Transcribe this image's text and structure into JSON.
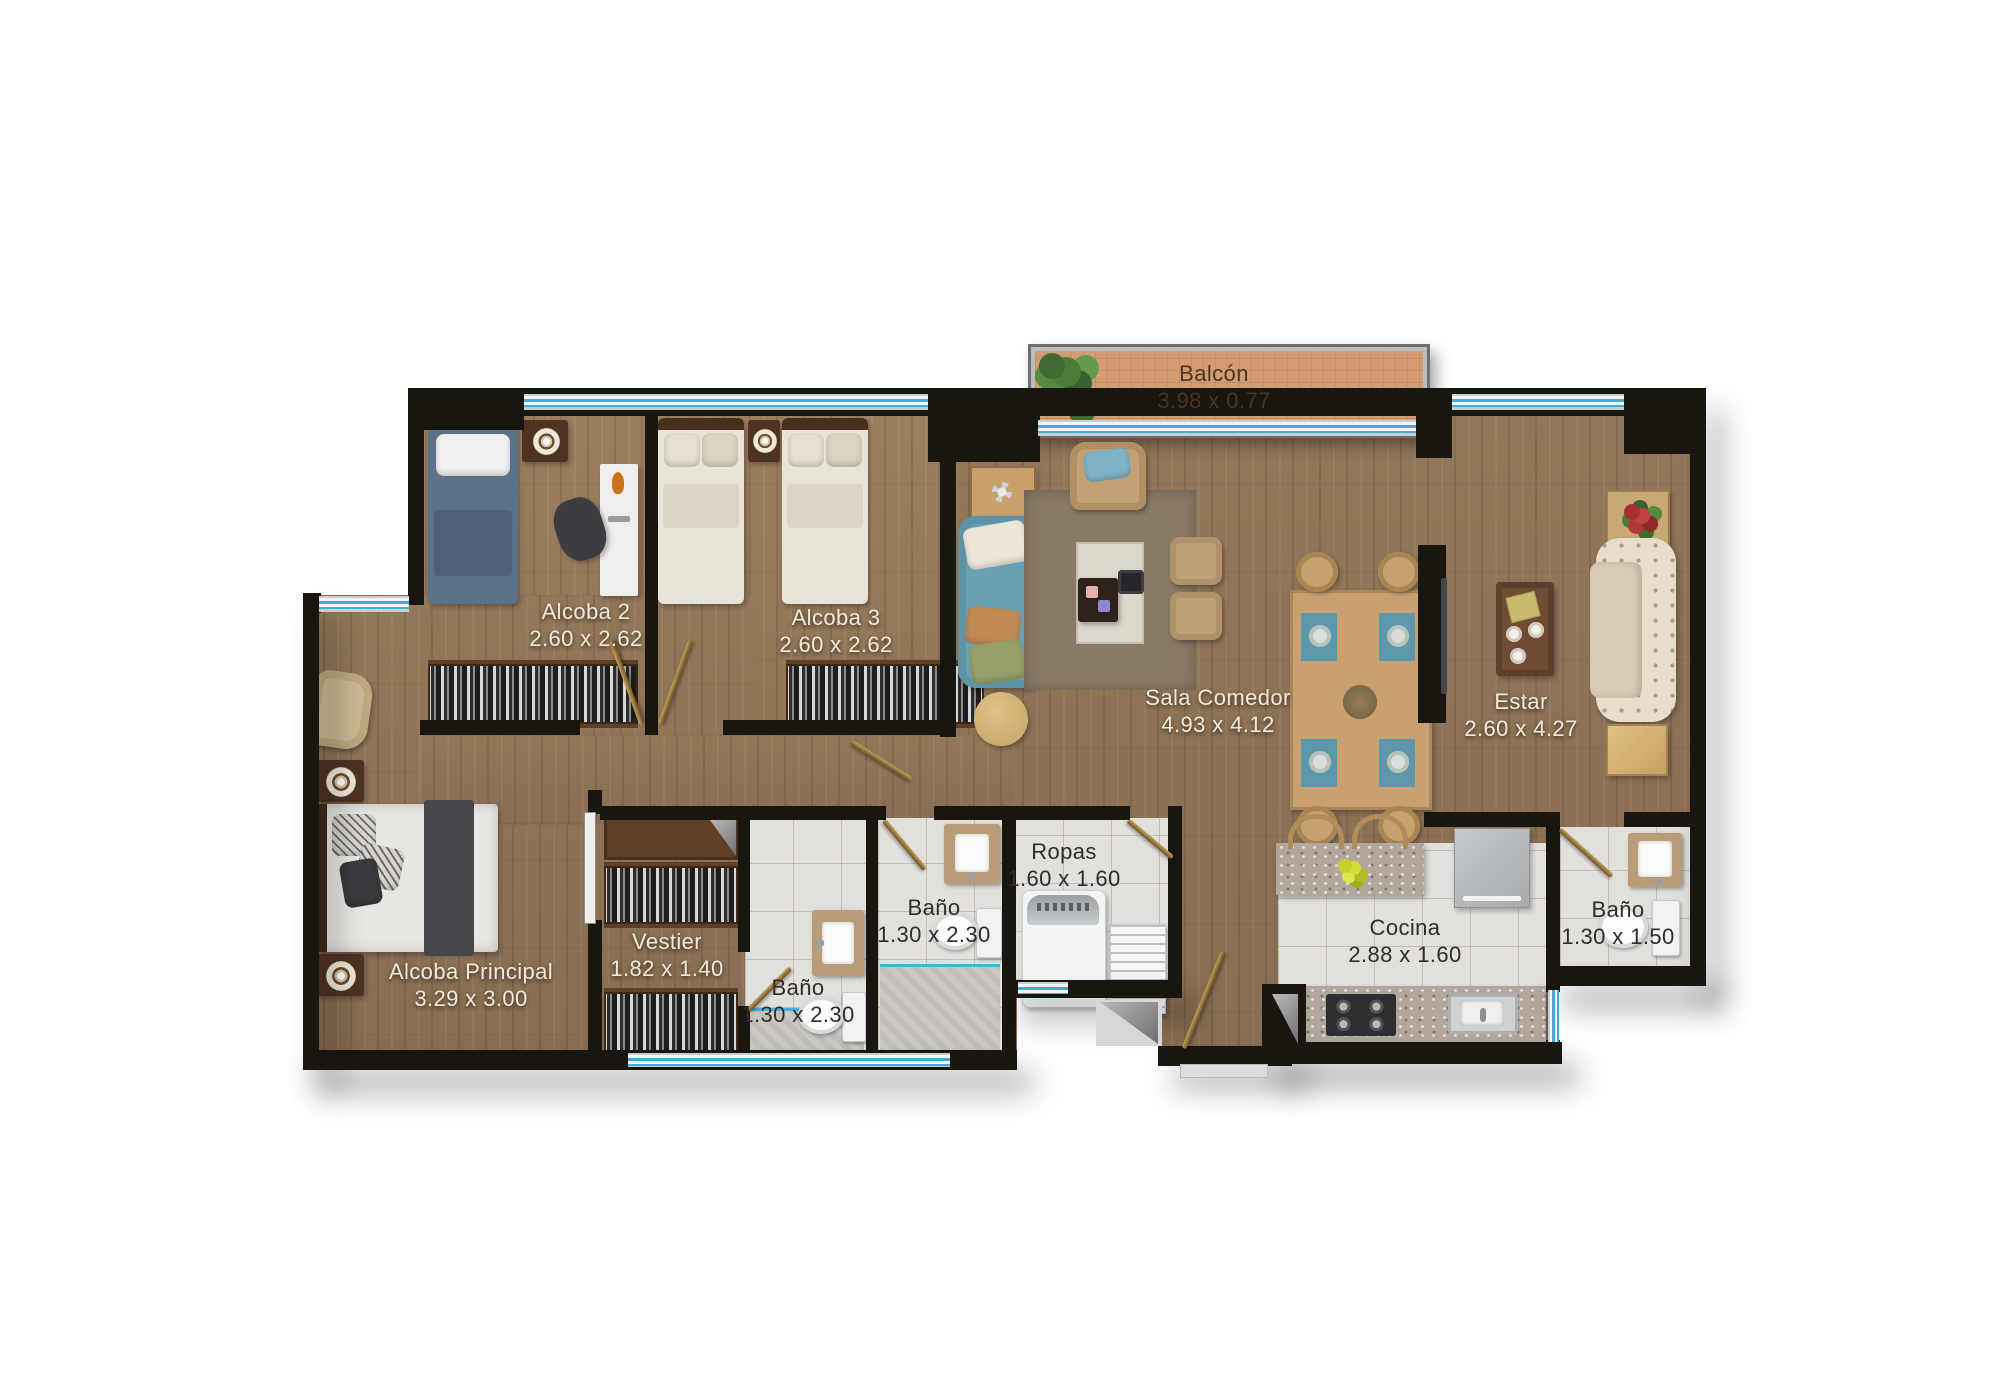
{
  "plan": {
    "type": "apartment-floor-plan",
    "language": "es",
    "rooms": {
      "balcon": {
        "name": "Balcón",
        "dims": "3.98 x 0.77"
      },
      "alcoba2": {
        "name": "Alcoba 2",
        "dims": "2.60 x 2.62"
      },
      "alcoba3": {
        "name": "Alcoba 3",
        "dims": "2.60 x 2.62"
      },
      "sala_comedor": {
        "name": "Sala Comedor",
        "dims": "4.93 x 4.12"
      },
      "estar": {
        "name": "Estar",
        "dims": "2.60 x 4.27"
      },
      "alcoba_principal": {
        "name": "Alcoba Principal",
        "dims": "3.29 x 3.00"
      },
      "vestier": {
        "name": "Vestier",
        "dims": "1.82 x 1.40"
      },
      "bano_principal": {
        "name": "Baño",
        "dims": "1.30 x 2.30"
      },
      "bano_social": {
        "name": "Baño",
        "dims": "1.30 x 2.30"
      },
      "ropas": {
        "name": "Ropas",
        "dims": "1.60 x 1.60"
      },
      "cocina": {
        "name": "Cocina",
        "dims": "2.88 x 1.60"
      },
      "bano_servicio": {
        "name": "Baño",
        "dims": "1.30 x 1.50"
      }
    },
    "colors": {
      "wall": "#19150f",
      "wood_floor": "#8e7457",
      "tile_floor": "#e2e0dd",
      "balcony_floor": "#d39c73",
      "window_glass": "#41acda",
      "label_light": "#f2e9d8",
      "label_dark": "#2f2d2a"
    }
  }
}
